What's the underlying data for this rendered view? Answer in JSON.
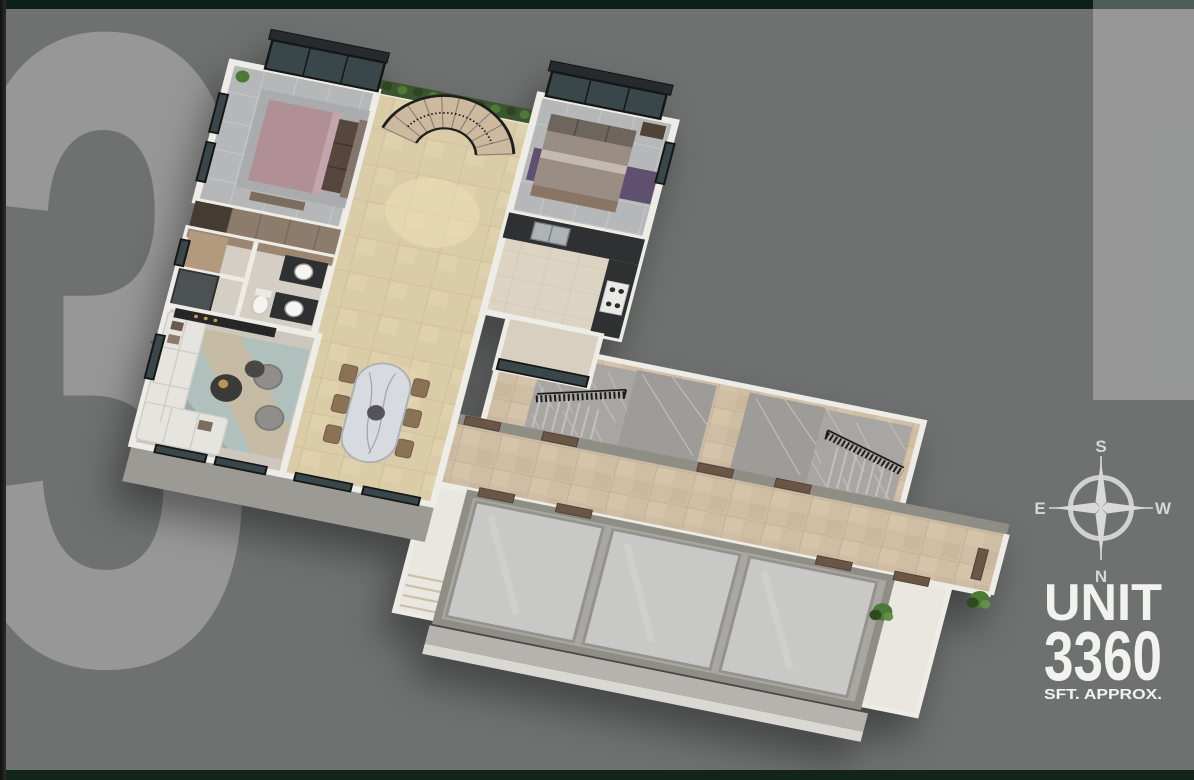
{
  "canvas": {
    "background": "#6f7070",
    "border_color": "#0e2219",
    "spine_color": "#1b1b1b"
  },
  "watermark": {
    "numeral": "3",
    "color": "rgba(255,255,255,0.28)"
  },
  "compass": {
    "top": "S",
    "right": "W",
    "bottom": "N",
    "left": "E",
    "color": "#d6d6d6"
  },
  "unit_badge": {
    "title": "UNIT",
    "number": "3360",
    "caption": "SFT. APPROX.",
    "color": "#f2f2f1"
  },
  "floorplan": {
    "palette": {
      "floor_beige": "#dbcca8",
      "grout_beige": "#cdbd99",
      "tile_gray": "#b5b7b9",
      "grout_gray": "#c9cbcc",
      "travertine": "#cfbda4",
      "travertine_grout": "#c0ae93",
      "kitchen_floor": "#ddd3c2",
      "kitchen_grout": "#d0c5b0",
      "marble_gray": "#a7a6a2",
      "marble_vein": "#c6c5c1",
      "wall_white": "#edece6",
      "wall_gray": "#8f8e86",
      "wall_face": "#9b9a95",
      "railing_dark": "#1c1c1c",
      "glass_dark": "#39464a",
      "frame_dark": "#161616",
      "door_wood": "#6b5544",
      "wood_brown": "#8d7b6c",
      "plant_green": "#4c7a35",
      "plant_dark": "#2f4a20",
      "bed_mauve": "#b18f97",
      "bed_taupe": "#9a8d84",
      "rug_purple": "#584768",
      "rug_teal": "#afc0bd",
      "rug_beige": "#c9b8a0",
      "sofa_white": "#e6e4df",
      "armchair_gray": "#908e8a",
      "counter_dark": "#2e3032",
      "steel": "#aeb4b6",
      "table_marble": "#d7dade",
      "chair_wood": "#8b7257",
      "lift_gray": "#c8c8c6",
      "lift_frame": "#93928c",
      "stair_step": "#cdb99e",
      "landing_slab": "#9d9c98",
      "white_floor": "#e9e7e0"
    }
  }
}
